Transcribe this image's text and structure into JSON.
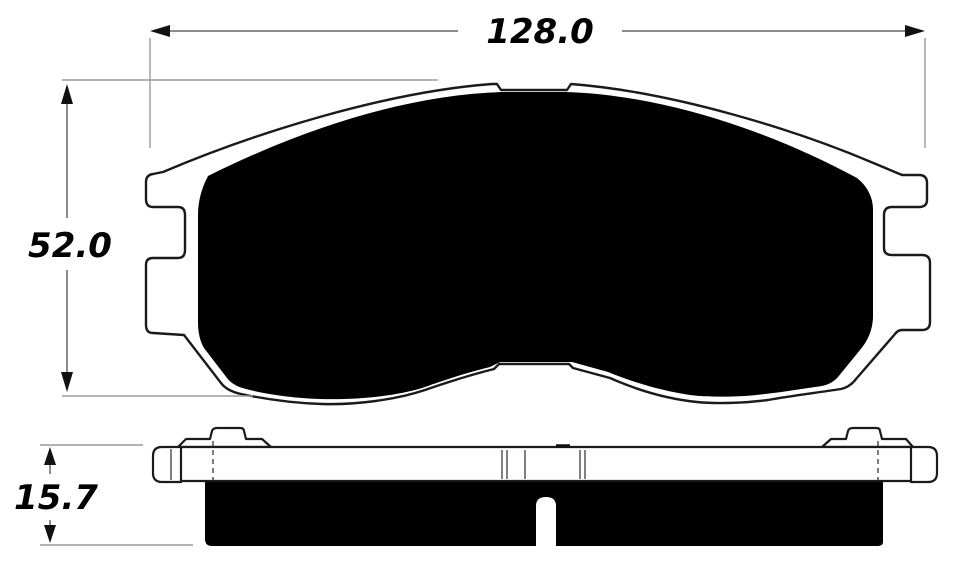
{
  "dimensions": {
    "width": {
      "value": "128.0"
    },
    "height": {
      "value": "52.0"
    },
    "thickness": {
      "value": "15.7"
    }
  },
  "colors": {
    "background": "#ffffff",
    "outline": "#1a1a1a",
    "fill": "#000000",
    "dimension_line": "#666666",
    "extension_line": "#9a9a9a",
    "text": "#000000"
  }
}
